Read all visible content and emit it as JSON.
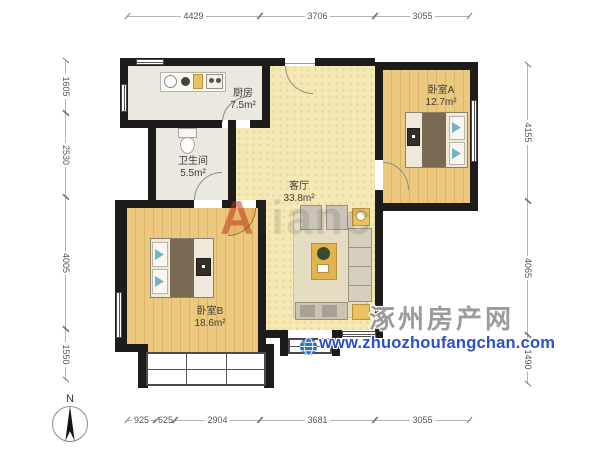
{
  "compass": {
    "label": "N"
  },
  "rooms": {
    "kitchen": {
      "name": "厨房",
      "area": "7.5m²"
    },
    "bathroom": {
      "name": "卫生间",
      "area": "5.5m²"
    },
    "living": {
      "name": "客厅",
      "area": "33.8m²"
    },
    "bedroomA": {
      "name": "卧室A",
      "area": "12.7m²"
    },
    "bedroomB": {
      "name": "卧室B",
      "area": "18.6m²"
    }
  },
  "dimensions": {
    "top": [
      "4429",
      "3706",
      "3055"
    ],
    "bottom": [
      "925",
      "625",
      "2904",
      "3681",
      "3055"
    ],
    "left": [
      "1605",
      "2530",
      "4005",
      "1550"
    ],
    "right": [
      "4155",
      "4065",
      "1490"
    ]
  },
  "watermark": {
    "brand_initial": "A",
    "brand_rest": "lianc",
    "site_name": "涿州房产网",
    "site_url": "www.zhuozhoufangchan.com"
  }
}
